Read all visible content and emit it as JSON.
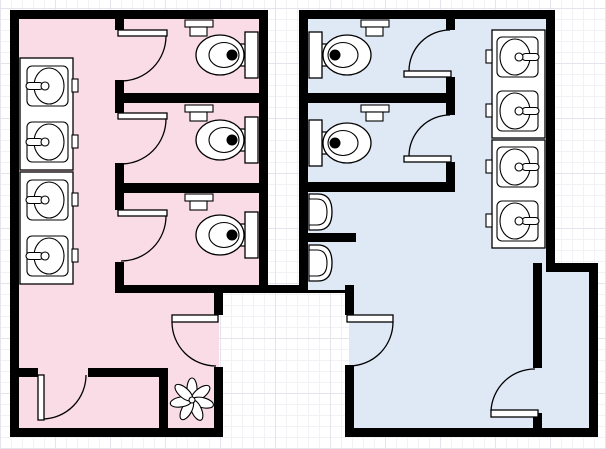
{
  "diagram": {
    "kind": "restroom-floor-plan",
    "rooms": [
      {
        "id": "womens-restroom",
        "floor_color_key": "womens_floor",
        "fixtures": {
          "sinks": 4,
          "soap_dispensers": 4,
          "toilet_stalls": 3,
          "toilets": 3,
          "toilet_paper_dispensers": 3,
          "stall_doors": 3,
          "entry_doors": 1,
          "closet_doors": 1,
          "plants": 1
        }
      },
      {
        "id": "mens-restroom",
        "floor_color_key": "mens_floor",
        "fixtures": {
          "sinks": 4,
          "soap_dispensers": 4,
          "toilet_stalls": 2,
          "toilets": 2,
          "urinals": 2,
          "toilet_paper_dispensers": 2,
          "stall_doors": 2,
          "entry_doors": 1,
          "closet_doors": 1,
          "plants": 0
        }
      }
    ]
  },
  "colors": {
    "womens_floor": "#fadce6",
    "mens_floor": "#dfe9f6",
    "wall": "#000000",
    "fixture_fill": "#ffffff",
    "fixture_stroke": "#000000",
    "grid_minor": "#f2f2f6",
    "grid_major": "#e4e4ec",
    "canvas": "#ffffff"
  }
}
